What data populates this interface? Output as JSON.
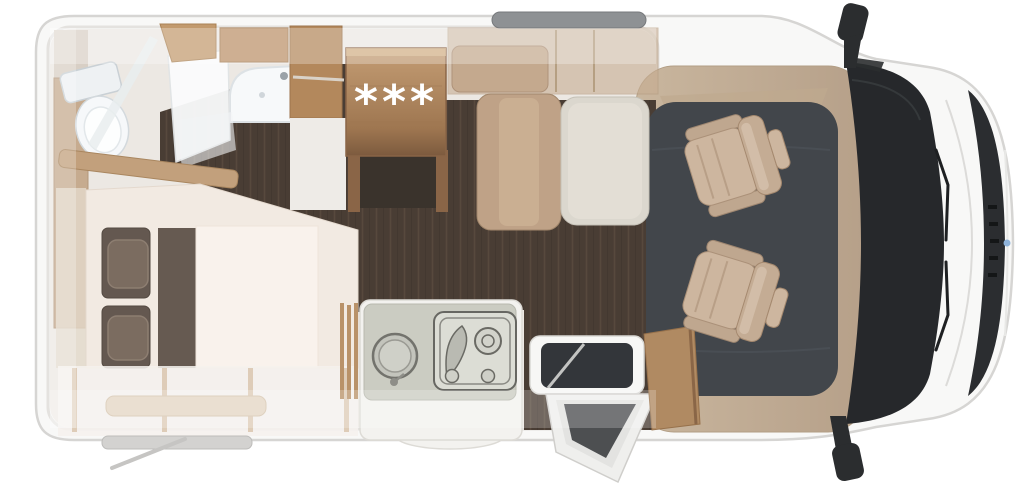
{
  "fridge": {
    "symbol": "***"
  },
  "colors": {
    "body_white": "#f8f8f7",
    "body_outline": "#d6d5d3",
    "interior_base": "#ece8e3",
    "wood_floor_dark": "#493d34",
    "wood_floor_plank": "#57493d",
    "cab_floor": "#42464b",
    "cabinet_wood": "#b68d63",
    "cabinet_wood_light": "#c9aa83",
    "fridge_wood_top": "#c49d74",
    "fridge_wood_bottom": "#7c5a3e",
    "seat_tan": "#ccb59e",
    "dinette_cushion": "#dcd8cf",
    "bed_mattress": "#f2eae2",
    "bed_duvet": "#f9f2ec",
    "bed_pillow": "#65584e",
    "kitchen_counter": "#cbccc2",
    "glass_dark": "#26282b",
    "mirror_black": "#2b2d2f",
    "roof_vent_gray": "#8e9194",
    "badge_blue": "#8fb3da"
  }
}
